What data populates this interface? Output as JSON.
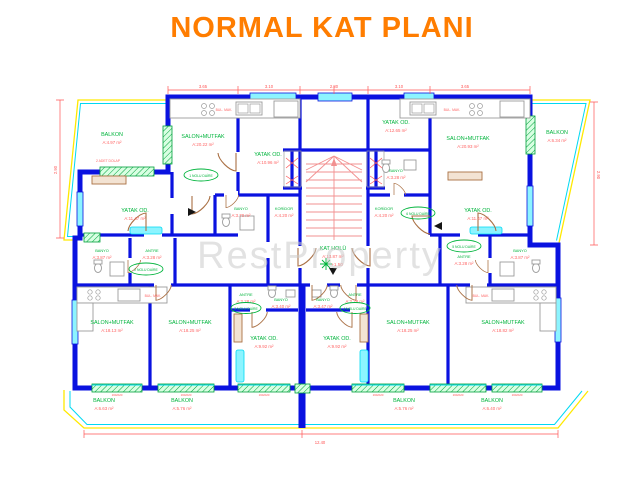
{
  "title": "NORMAL KAT PLANI",
  "watermark": "RestProperty",
  "colors": {
    "title": "#ff7d00",
    "wall": "#0a12e0",
    "window_fill": "#8cf4ff",
    "window_line": "#00d9f2",
    "balcony_line": "#ffe900",
    "room_label": "#00b43c",
    "area_label": "#ff6464",
    "stair_line": "#f29090",
    "door": "#aa7044",
    "fixture": "#9b9b9b",
    "watermark": "#cccccc"
  },
  "rooms": [
    {
      "name": "BALKON",
      "area": "A:4.97 m²"
    },
    {
      "name": "SALON+MUTFAK",
      "area": "A:20.22 m²"
    },
    {
      "name": "YATAK OD.",
      "area": "A:10.96 m²"
    },
    {
      "name": "YATAK OD.",
      "area": "A:12.65 m²"
    },
    {
      "name": "SALON+MUTFAK",
      "area": "A:20.93 m²"
    },
    {
      "name": "BALKON",
      "area": "A:6.34 m²"
    },
    {
      "name": "BANYO",
      "area": "A:3.70 m²"
    },
    {
      "name": "KORİDOR",
      "area": "A:4.20 m²"
    },
    {
      "name": "BANYO",
      "area": "A:3.28 m²"
    },
    {
      "name": "KORİDOR",
      "area": "A:4.20 m²"
    },
    {
      "name": "KAT HOLÜ",
      "area": "A:13.87 m²"
    },
    {
      "name": "YATAK OD.",
      "area": "A:11.47 m²"
    },
    {
      "name": "ANTRE",
      "area": "A:3.28 m²"
    },
    {
      "name": "BANYO",
      "area": "A:3.87 m²"
    },
    {
      "name": "YATAK OD.",
      "area": "A:11.47 m²"
    },
    {
      "name": "ANTRE",
      "area": "A:3.28 m²"
    },
    {
      "name": "BANYO",
      "area": "A:3.87 m²"
    },
    {
      "name": "SALON+MUTFAK",
      "area": "A:18.13 m²"
    },
    {
      "name": "SALON+MUTFAK",
      "area": "A:18.25 m²"
    },
    {
      "name": "ANTRE",
      "area": "A:2.28 m²"
    },
    {
      "name": "BANYO",
      "area": "A:3.40 m²"
    },
    {
      "name": "YATAK OD.",
      "area": "A:9.92 m²"
    },
    {
      "name": "BANYO",
      "area": "A:3.47 m²"
    },
    {
      "name": "ANTRE",
      "area": "A:2.28 m²"
    },
    {
      "name": "YATAK OD.",
      "area": "A:9.92 m²"
    },
    {
      "name": "SALON+MUTFAK",
      "area": "A:18.25 m²"
    },
    {
      "name": "SALON+MUTFAK",
      "area": "A:18.82 m²"
    },
    {
      "name": "BALKON",
      "area": "A:6.63 m²"
    },
    {
      "name": "BALKON",
      "area": "A:5.76 m²"
    },
    {
      "name": "BALKON",
      "area": "A:5.76 m²"
    },
    {
      "name": "BALKON",
      "area": "A:6.40 m²"
    }
  ],
  "flats": [
    "1 NOLU DAİRE",
    "2 NOLU DAİRE",
    "3 NOLU DAİRE",
    "4 NOLU DAİRE",
    "5 NOLU DAİRE",
    "6 NOLU DAİRE"
  ],
  "core": {
    "hall_name": "KAT HOLÜ",
    "hall_area": "A:13.87 m²",
    "level": "+1.50"
  },
  "labels": {
    "dishwasher": "BUL. MAK.",
    "wardrobe": "2 ADET DOLAP"
  },
  "dims": {
    "top": [
      "3.65",
      "3.10",
      "2.80",
      "3.10",
      "3.65"
    ],
    "left": "2.90",
    "right": "2.90",
    "bottom": "12.40",
    "window": "160/220"
  }
}
